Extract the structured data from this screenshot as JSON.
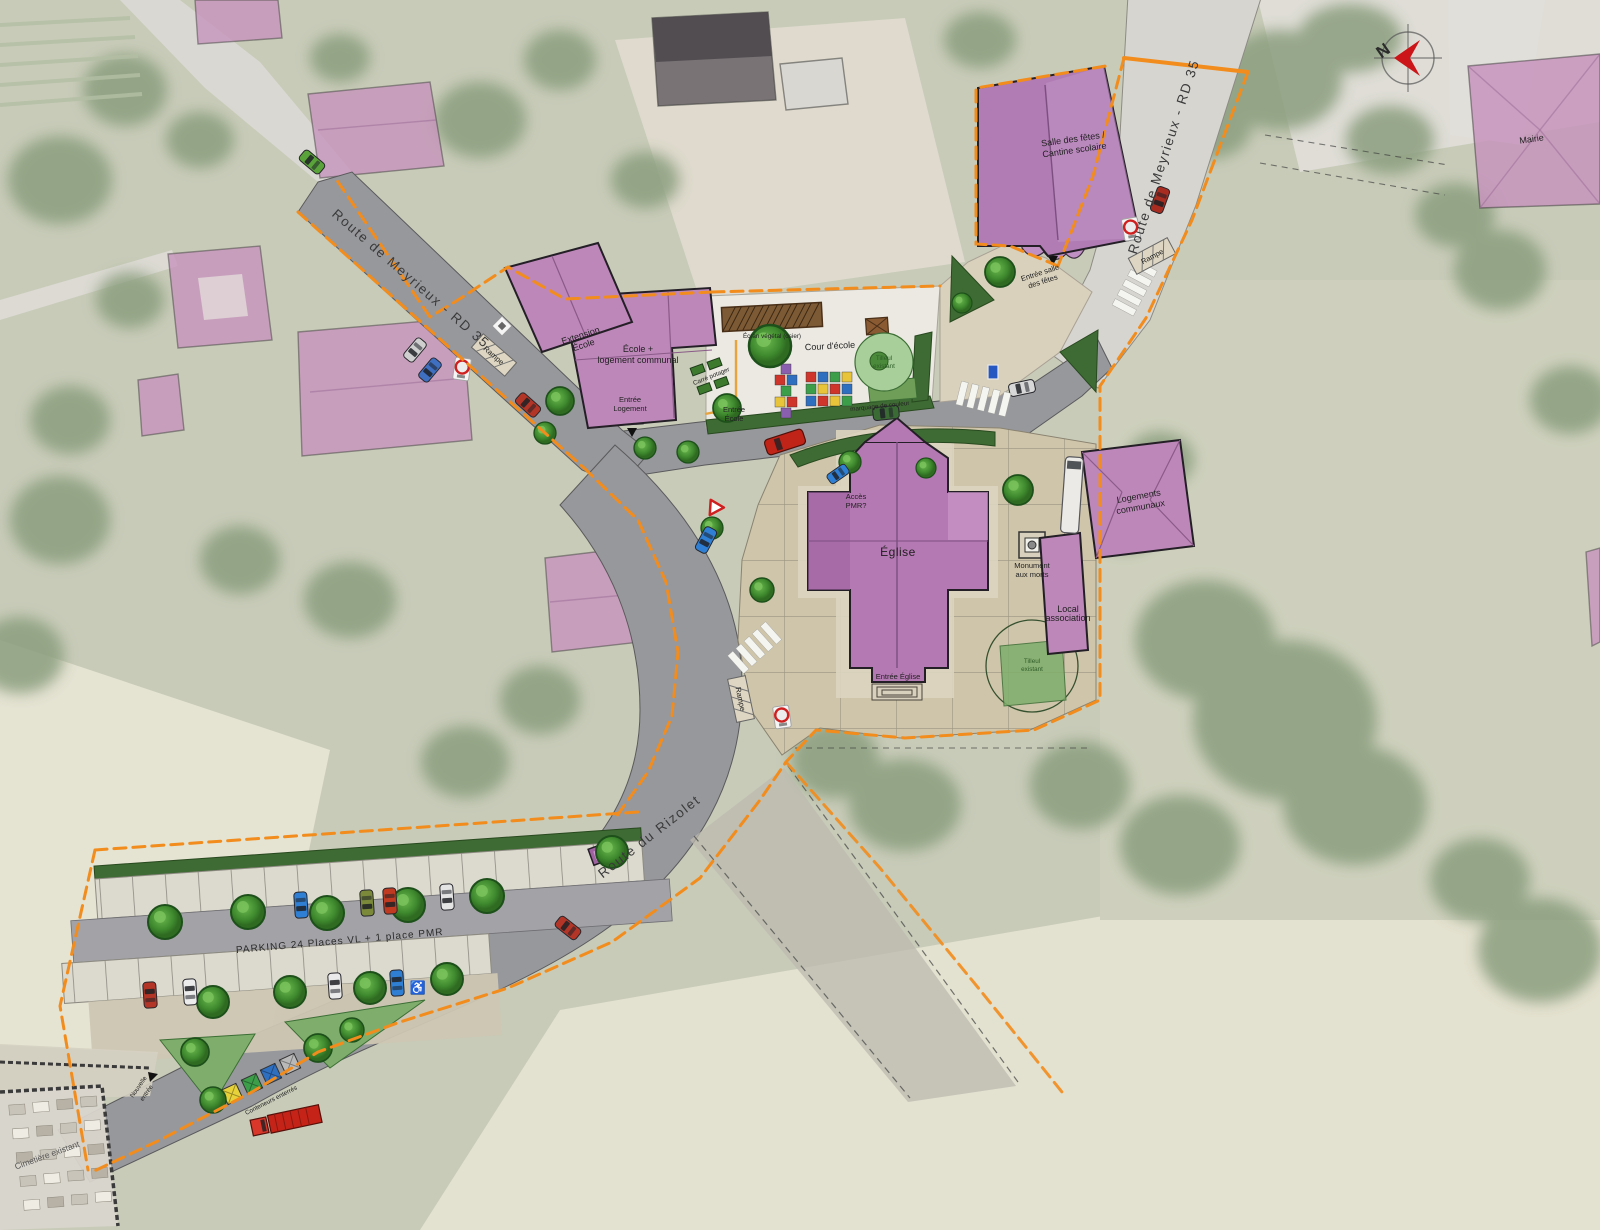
{
  "north_label": "N",
  "roads": {
    "meyrieux": "Route de Meyrieux - RD 35",
    "rizolet": "Route du Rizolet"
  },
  "buildings": {
    "mairie": "Mairie",
    "salle1": "Salle des fêtes /",
    "salle2": "Cantine scolaire",
    "ecole1": "École +",
    "ecole2": "logement communal",
    "ext1": "Extension",
    "ext2": "École",
    "eglise": "Église",
    "logements1": "Logements",
    "logements2": "communaux",
    "local1": "Local",
    "local2": "association"
  },
  "site": {
    "cour": "Cour d'école",
    "marquage": "marquage de couleur",
    "potager": "Carré potager",
    "ecran": "Écran végétal (osier)",
    "tilleul1": "Tilleul",
    "tilleul2": "existant",
    "monument1": "Monument",
    "monument2": "aux morts",
    "acces1": "Accès",
    "acces2": "PMR?",
    "entree_eglise": "Entrée Église",
    "entree_ecole1": "Entrée",
    "entree_ecole2": "École",
    "entree_logement1": "Entrée",
    "entree_logement2": "Logement",
    "entree_salle1": "Entrée salle",
    "entree_salle2": "des fêtes",
    "rampe": "Rampe",
    "parking": "PARKING 24 Places VL + 1 place PMR",
    "conteneurs": "Conteneurs enterrés",
    "cimetiere": "Cimetière existant",
    "nouvelle1": "Nouvelle",
    "nouvelle2": "entrée"
  },
  "colors": {
    "building_purple": "#b478b2",
    "building_pink_faded": "#c795bd",
    "boundary_orange": "#f28c1c",
    "road_gray": "#97989c",
    "plaza_tan": "#cfc5aa",
    "tree_green": "#3a7f2c",
    "north_red": "#cc1518"
  }
}
